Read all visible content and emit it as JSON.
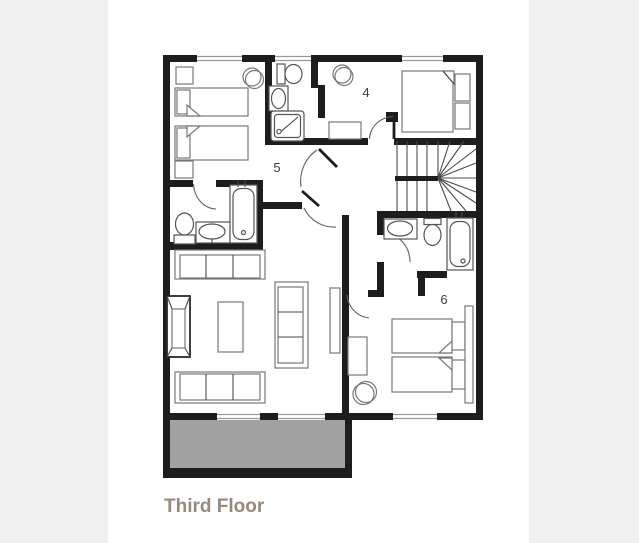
{
  "page": {
    "background_color": "#efefef",
    "card_background_color": "#ffffff"
  },
  "floorplan": {
    "caption": "Third Floor",
    "caption_color": "#98897a",
    "wall_color": "#1d1d1d",
    "window_color": "#9a9a9a",
    "balcony_fill": "#a2a2a2",
    "furniture_stroke": "#777777",
    "rooms": [
      {
        "id": "bedroom-4",
        "label": "4",
        "furniture": [
          "double-bed",
          "stool",
          "bench"
        ]
      },
      {
        "id": "bedroom-5",
        "label": "5",
        "furniture": [
          "twin-bed",
          "twin-bed",
          "nightstand",
          "nightstand",
          "stool"
        ]
      },
      {
        "id": "bedroom-6",
        "label": "6",
        "furniture": [
          "twin-bed",
          "twin-bed",
          "wardrobe",
          "desk",
          "stool",
          "radiator"
        ]
      }
    ],
    "bathrooms": [
      {
        "id": "bathroom-top",
        "fixtures": [
          "toilet",
          "washbasin",
          "shower"
        ]
      },
      {
        "id": "bathroom-left",
        "fixtures": [
          "toilet",
          "washbasin",
          "bathtub"
        ]
      },
      {
        "id": "bathroom-right",
        "fixtures": [
          "washbasin",
          "toilet",
          "bathtub"
        ]
      }
    ],
    "living_room": {
      "furniture": [
        "sofa",
        "sofa",
        "armchair",
        "coffee-table",
        "sofa-unit"
      ]
    },
    "features": [
      "staircase-with-winder",
      "balcony",
      "windows",
      "sliding-doors"
    ]
  }
}
